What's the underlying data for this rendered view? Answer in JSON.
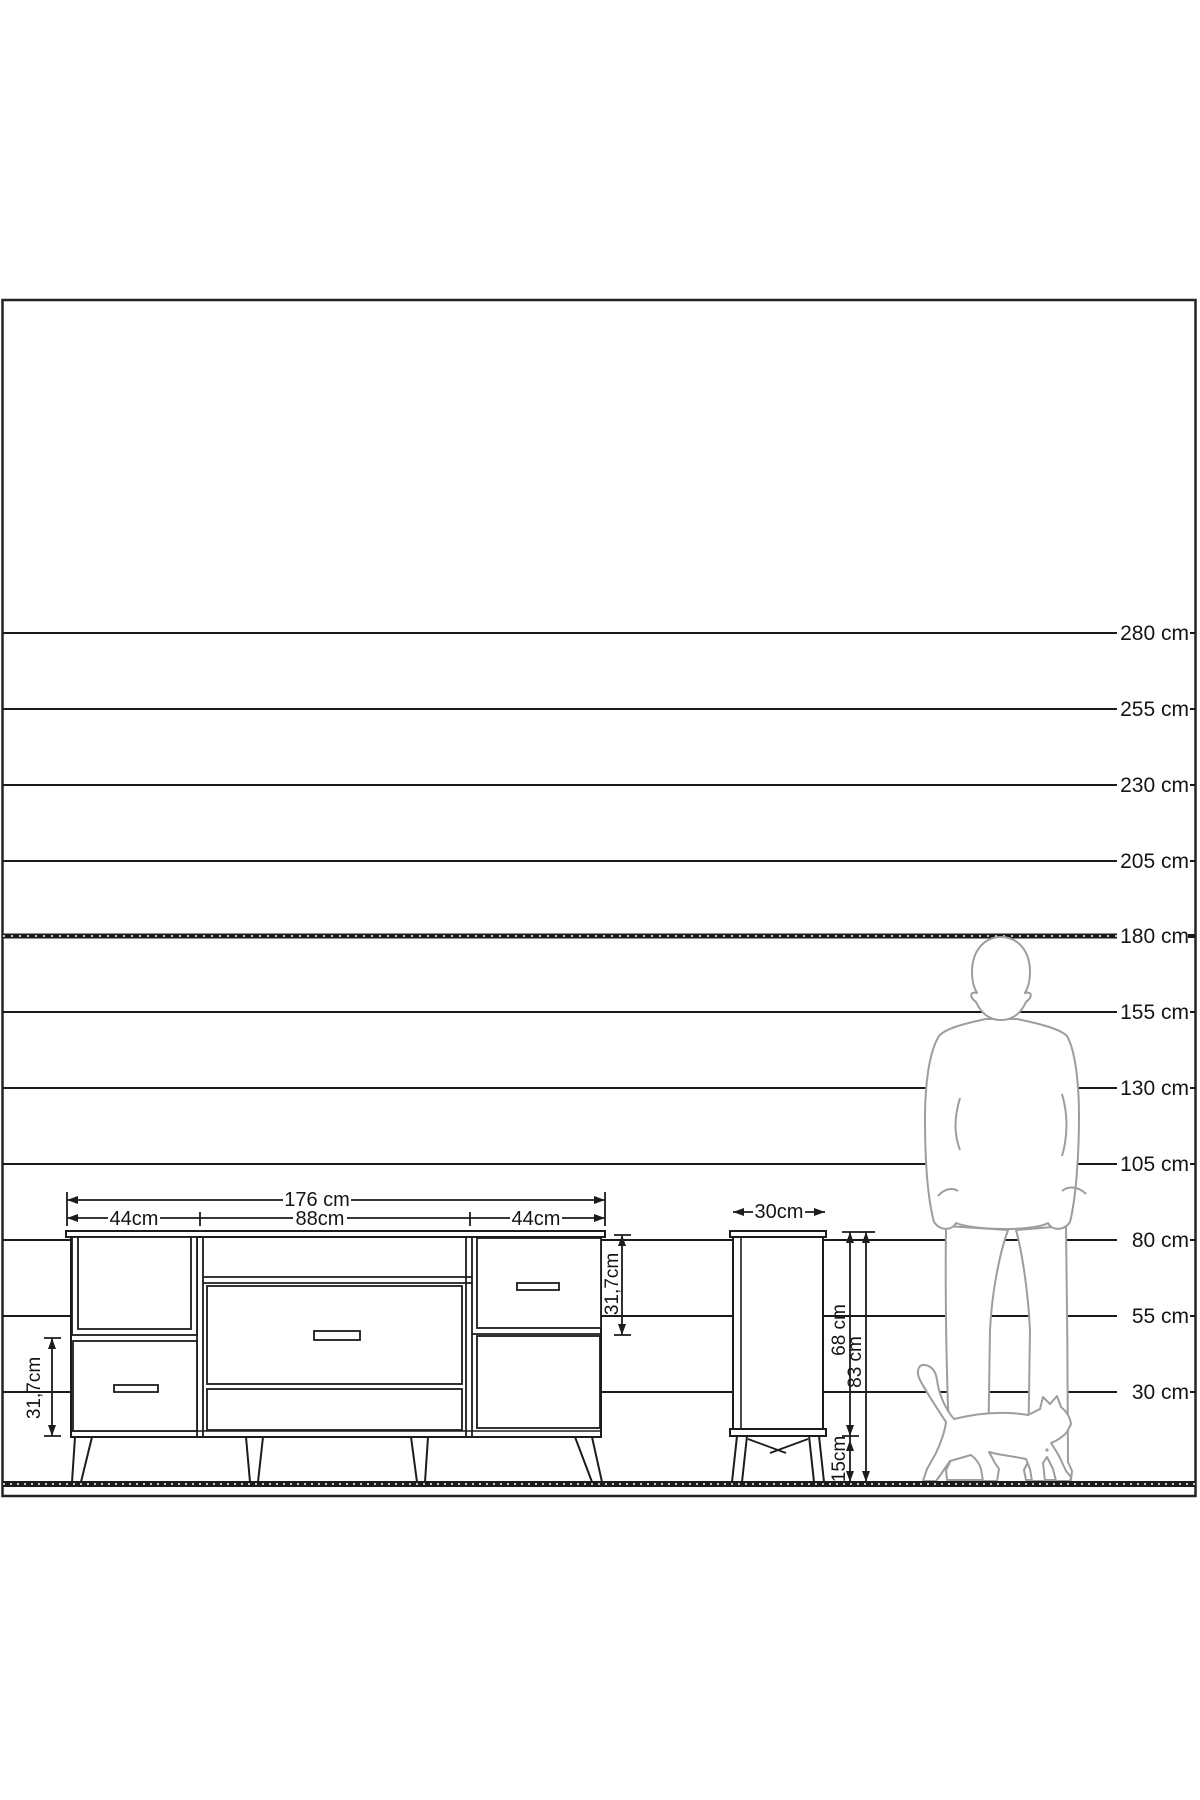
{
  "scale_ruler": {
    "labels": [
      "280 cm",
      "255 cm",
      "230 cm",
      "205 cm",
      "180 cm",
      "155 cm",
      "130 cm",
      "105 cm",
      "80 cm",
      "55 cm",
      "30 cm"
    ]
  },
  "sideboard": {
    "width_total": "176 cm",
    "width_left": "44cm",
    "width_middle": "88cm",
    "width_right": "44cm",
    "left_drawer_height": "31,7cm",
    "right_drawer_height": "31,7cm"
  },
  "side_cabinet": {
    "depth": "30cm",
    "body_height": "68 cm",
    "total_height": "83 cm",
    "leg_height": "15cm"
  },
  "colors": {
    "ink": "#1a1a1a",
    "silhouette_outline": "#9d9d9d",
    "background": "#ffffff"
  }
}
